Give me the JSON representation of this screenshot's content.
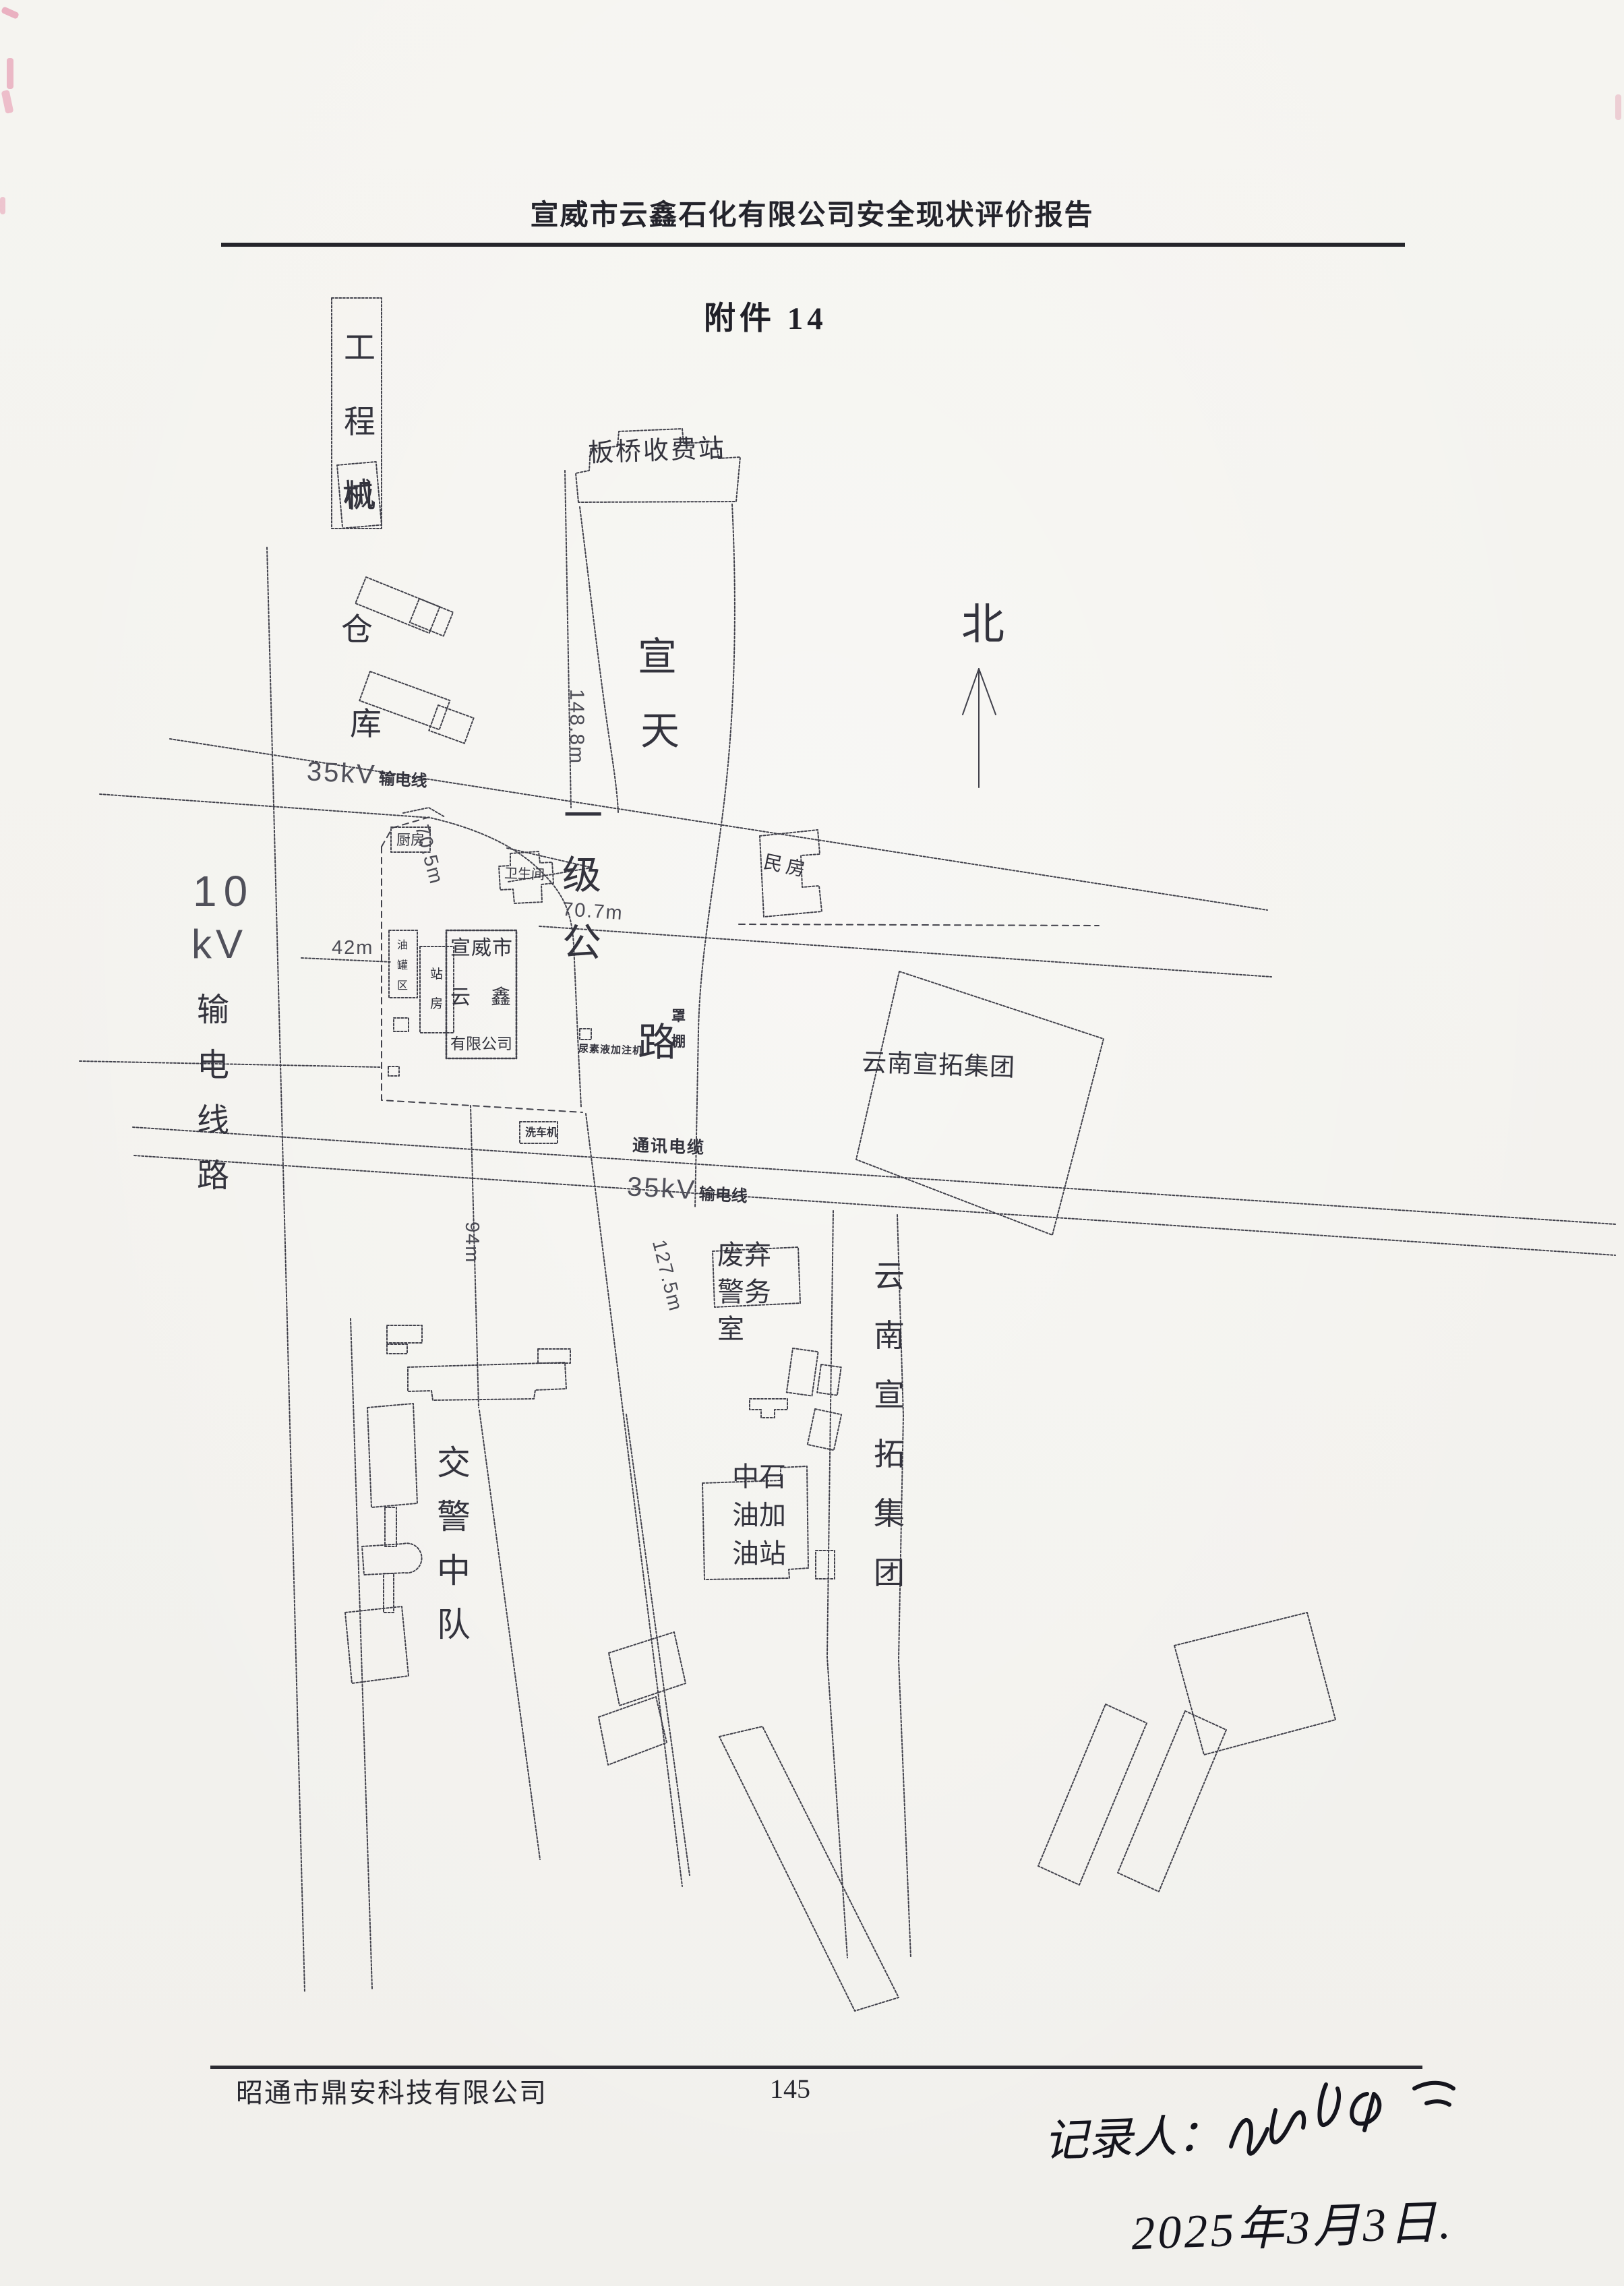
{
  "page": {
    "header_title": "宣威市云鑫石化有限公司安全现状评价报告",
    "attachment_label": "附件 14",
    "footer_company": "昭通市鼎安科技有限公司",
    "page_number": "145",
    "handwriting": {
      "recorder_label": "记录人：",
      "date": "2025年3月3日."
    }
  },
  "map": {
    "north": "北",
    "toll_station": "板桥收费站",
    "warehouse": {
      "box": "工程机",
      "char4": "械",
      "char5": "仓",
      "char6": "库"
    },
    "highway_chars": [
      "宣",
      "天",
      "一",
      "级",
      "公",
      "路"
    ],
    "power10": {
      "line1": "10",
      "line2": "kV",
      "vertical": "输电线路"
    },
    "power35_upper": {
      "num": "35kV",
      "txt": "输电线"
    },
    "power35_lower": {
      "num": "35kV",
      "txt": "输电线"
    },
    "telecom_cable": "通讯电缆",
    "dims": {
      "d148": "148.8m",
      "d705": "70.5m",
      "d707": "70.7m",
      "d42": "42m",
      "d94": "94m",
      "d1275": "127.5m"
    },
    "station": {
      "company_lines": [
        "宣威市",
        "云　鑫",
        "有限公司"
      ],
      "kitchen": "厨房",
      "restroom": "卫生间",
      "tank_area": "油罐区",
      "station_house": "站房",
      "car_wash": "洗车机",
      "canopy": "罩棚",
      "urea_machine": "尿素液加注机"
    },
    "residence": "民房",
    "xuantuo_block": "云南宣拓集团",
    "xuantuo_strip": "云南宣拓集团",
    "police_room_lines": [
      "废弃",
      "警务",
      "室"
    ],
    "cnpc_lines": [
      "中石",
      "油加",
      "油站"
    ],
    "traffic_police": "交警中队"
  }
}
